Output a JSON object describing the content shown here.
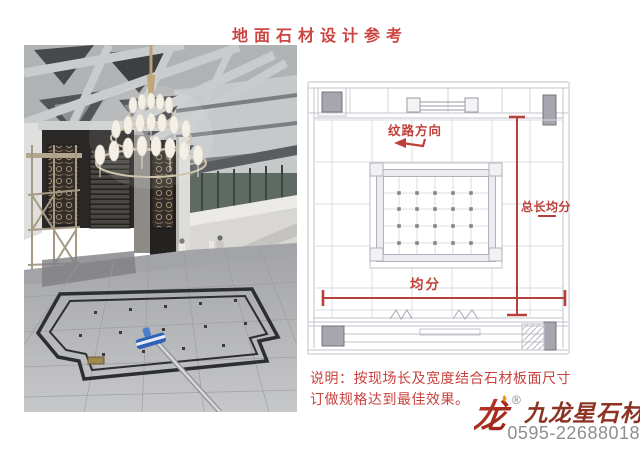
{
  "page": {
    "title": "地面石材设计参考",
    "colors": {
      "accent_red": "#cc4440",
      "annotation_red": "#bf4038",
      "diagram_line": "#c3c3cb",
      "logo_red": "#b5342a",
      "logo_flame_orange": "#e8940c",
      "brand_text_red": "#8c3324",
      "phone_gray": "#8f8f91"
    }
  },
  "diagram": {
    "grain_direction_label": "纹路方向",
    "total_length_label": "总长均分",
    "equal_division_label": "均分"
  },
  "note": {
    "line1": "说明：按现场长及宽度结合石材板面尺寸",
    "line2": "订做规格达到最佳效果。"
  },
  "branding": {
    "logo_glyph": "龙",
    "registered_mark": "®",
    "company_name": "九龙星石材",
    "phone": "0595-22688018"
  }
}
